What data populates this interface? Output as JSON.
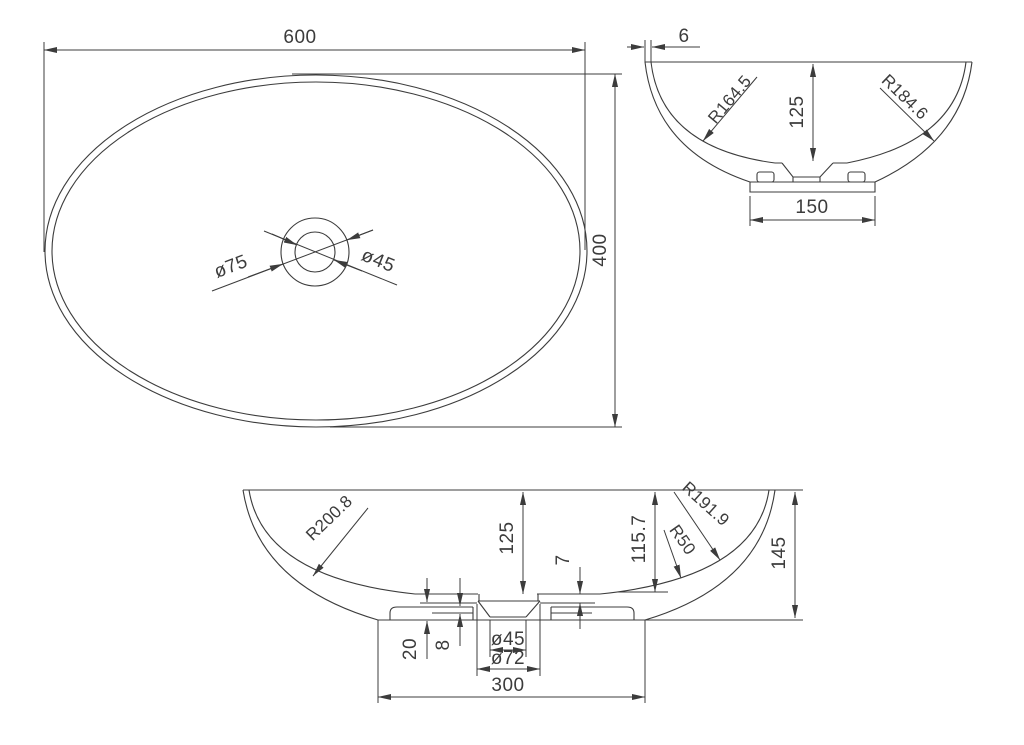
{
  "drawing_title": "Oval washbasin technical drawing",
  "colors": {
    "line": "#3c3c3c",
    "background": "#ffffff"
  },
  "views": {
    "top": {
      "dim_width": "600",
      "dim_height": "400",
      "dim_drain_outer": "ø75",
      "dim_drain_inner": "ø45"
    },
    "side": {
      "dim_wall_thickness": "6",
      "dim_inner_radius": "R164.5",
      "dim_depth": "125",
      "dim_outer_radius": "R184.6",
      "dim_base_width": "150"
    },
    "front": {
      "dim_outer_radius": "R200.8",
      "dim_depth": "125",
      "dim_floor_thickness": "7",
      "dim_inner_depth": "115.7",
      "dim_inner_radius": "R191.9",
      "dim_fillet_radius": "R50",
      "dim_total_height": "145",
      "dim_recess_depth": "20",
      "dim_step_height": "8",
      "dim_drain_hole": "ø45",
      "dim_drain_recess": "ø72",
      "dim_base_width": "300"
    }
  }
}
